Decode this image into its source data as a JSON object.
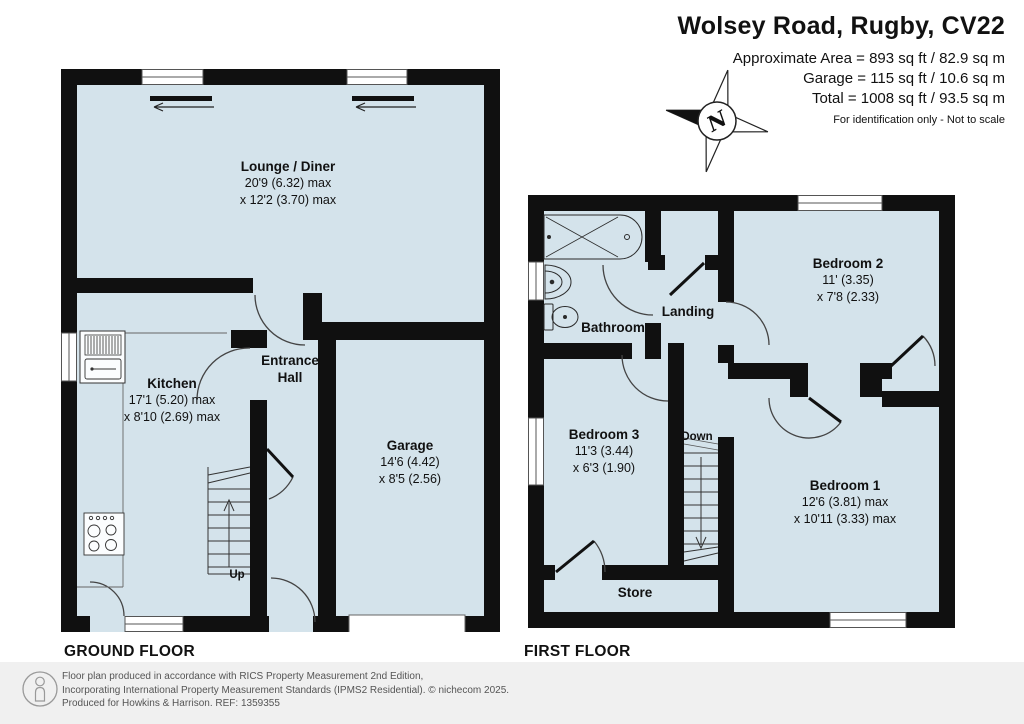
{
  "header": {
    "title": "Wolsey Road, Rugby, CV22",
    "line1": "Approximate Area = 893 sq ft / 82.9 sq m",
    "line2": "Garage = 115 sq ft / 10.6 sq m",
    "line3": "Total = 1008 sq ft / 93.5 sq m",
    "note": "For identification only - Not to scale"
  },
  "compass": {
    "north": "N"
  },
  "colors": {
    "room_fill": "#d4e3eb",
    "wall": "#101010",
    "footer_bg": "#f0f0f0"
  },
  "ground_floor": {
    "label": "GROUND FLOOR",
    "lounge": {
      "name": "Lounge / Diner",
      "dim1": "20'9 (6.32) max",
      "dim2": "x 12'2 (3.70) max"
    },
    "kitchen": {
      "name": "Kitchen",
      "dim1": "17'1 (5.20) max",
      "dim2": "x 8'10 (2.69) max"
    },
    "hall": {
      "line1": "Entrance",
      "line2": "Hall"
    },
    "garage": {
      "name": "Garage",
      "dim1": "14'6 (4.42)",
      "dim2": "x 8'5 (2.56)"
    },
    "stairs": {
      "label": "Up"
    }
  },
  "first_floor": {
    "label": "FIRST FLOOR",
    "bathroom": {
      "name": "Bathroom"
    },
    "landing": {
      "name": "Landing"
    },
    "bedroom2": {
      "name": "Bedroom 2",
      "dim1": "11' (3.35)",
      "dim2": "x 7'8 (2.33)"
    },
    "bedroom3": {
      "name": "Bedroom 3",
      "dim1": "11'3 (3.44)",
      "dim2": "x 6'3 (1.90)"
    },
    "bedroom1": {
      "name": "Bedroom 1",
      "dim1": "12'6 (3.81) max",
      "dim2": "x 10'11 (3.33) max"
    },
    "store": {
      "name": "Store"
    },
    "stairs": {
      "label": "Down"
    }
  },
  "footer": {
    "line1": "Floor plan produced in accordance with RICS Property Measurement 2nd Edition,",
    "line2": "Incorporating International Property Measurement Standards (IPMS2 Residential).   © nichecom 2025.",
    "line3": "Produced for Howkins & Harrison.   REF: 1359355"
  }
}
